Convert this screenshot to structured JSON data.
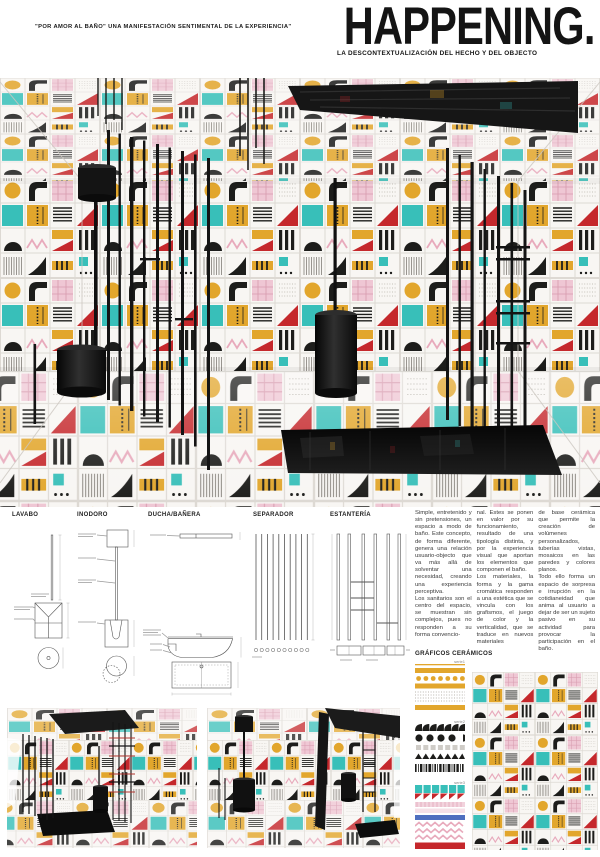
{
  "header": {
    "quote": "\"POR AMOR AL BAÑO\" UNA MANIFESTACIÓN SENTIMENTAL DE LA EXPERIENCIA\"",
    "title": "HAPPENING.",
    "subtitle": "LA DESCONTEXTUALIZACIÓN DEL HECHO Y DEL OBJECTO"
  },
  "drawings": {
    "items": [
      {
        "label": "LAVABO"
      },
      {
        "label": "INODORO"
      },
      {
        "label": "DUCHA/BAÑERA"
      },
      {
        "label": "SEPARADOR"
      },
      {
        "label": "ESTANTERÍA"
      }
    ]
  },
  "body_text": {
    "col1": "Simple, entretenido y sin pretensiones, un espacio a modo de baño. Este concepto, de forma diferente, genera una relación usuario-objecto que va más allá de solventar una necesidad, creando una experiencia perceptiva.\nLos sanitarios son el centro del espacio, se muestran sin complejos, pues no responden a su forma convencio-",
    "col2": "nal. Estes se ponen en valor por su funcionamiento, resultado de una tipología distinta, y por la experiencia visual que aportan los elementos que componen el baño.\nLos materiales, la forma y la gama cromática responden a una estética que se vincula con los grafismos, el juego de color y la verticalidad, que se traduce en nuevos materiales",
    "col3": "de base cerámica que permite la creación de volúmenes personalizados, tuberías vistas, mosaicos en las paredes y colores planos.\nTodo ello forma un espacio de sorpresa e irrupción en la cotidianeidad que anima al usuario a dejar de ser un sujeto pasivo en su actividad para provocar la participación en el baño."
  },
  "graficos": {
    "heading": "GRÁFICOS CERÁMICOS",
    "series": [
      {
        "label": "serie1"
      },
      {
        "label": "serie2"
      },
      {
        "label": "serie3"
      }
    ]
  },
  "palette": {
    "yellow": "#E2A62C",
    "teal": "#38BFB9",
    "red": "#C5282C",
    "pink": "#EFC7D4",
    "blue": "#4F6FBF",
    "black": "#1D1D1B",
    "grout": "#DDD9D3"
  }
}
